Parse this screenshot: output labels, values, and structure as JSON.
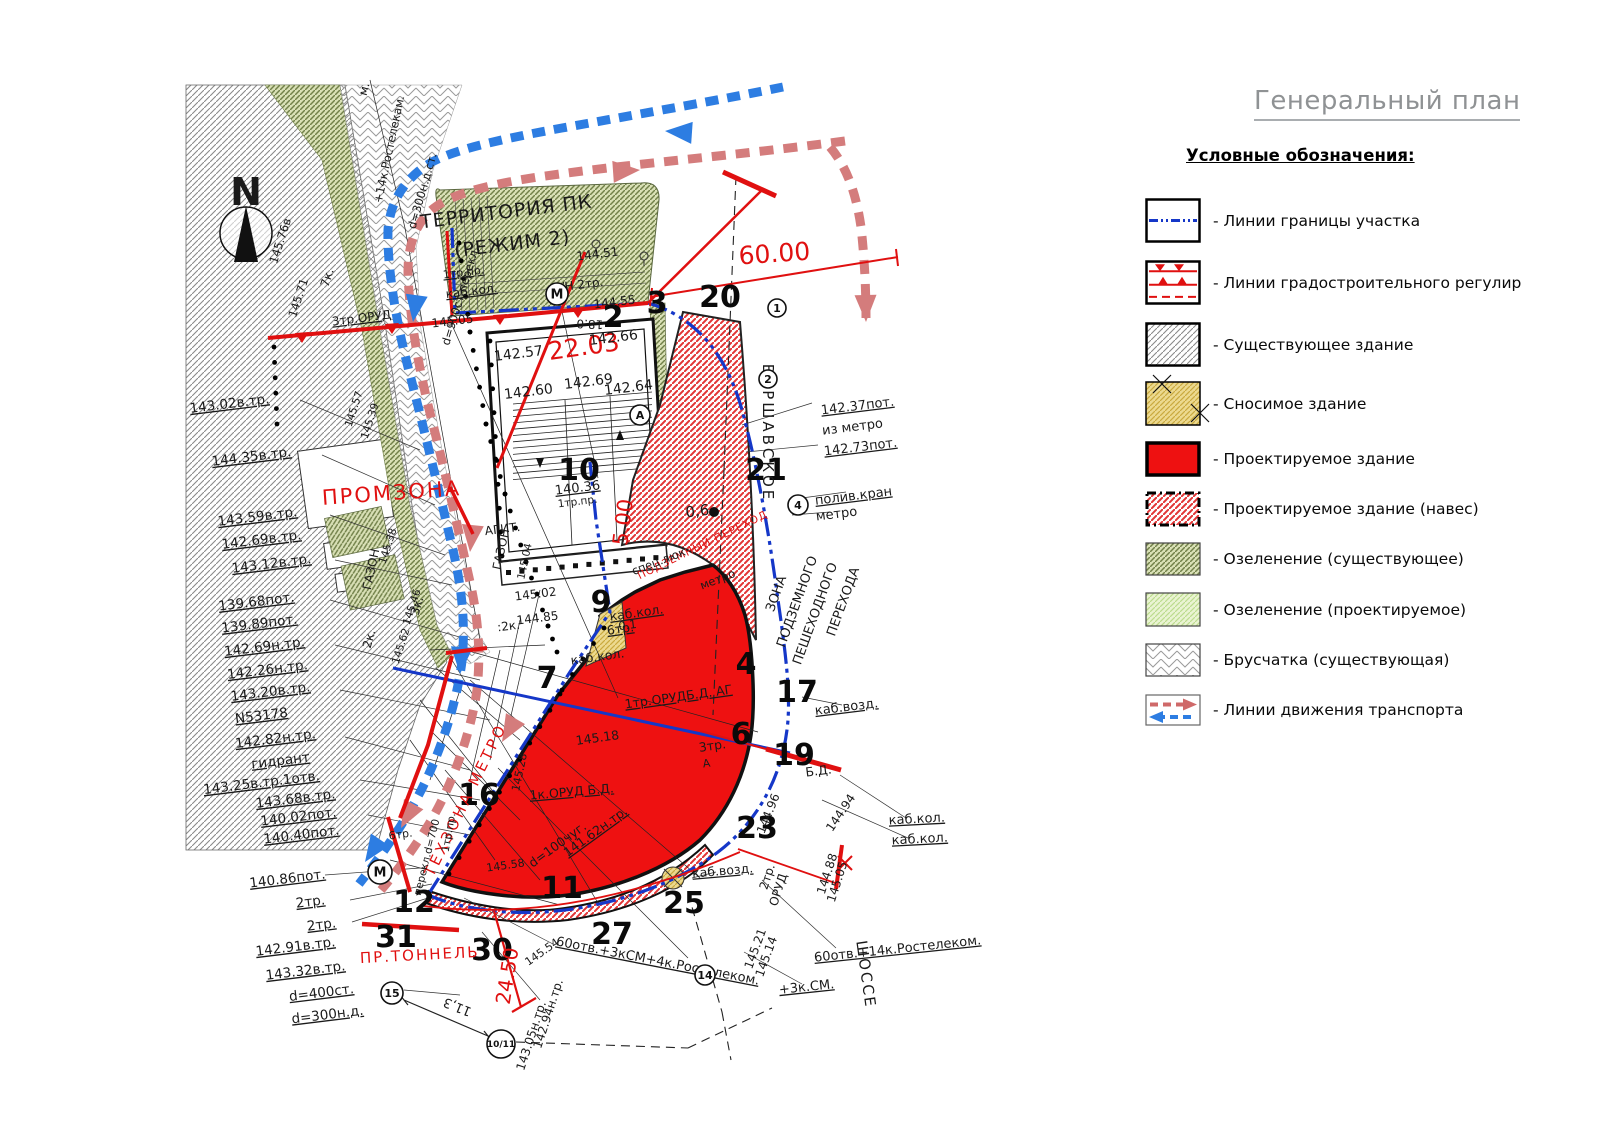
{
  "title": "Генеральный план",
  "legend": {
    "heading": "Условные обозначения:",
    "items": [
      {
        "swatch": "boundary-line",
        "label": "- Линии границы участка"
      },
      {
        "swatch": "regulation-lines",
        "label": "- Линии градостроительного регулир"
      },
      {
        "swatch": "existing-building",
        "label": "- Существующее здание"
      },
      {
        "swatch": "demolished-building",
        "label": "- Сносимое здание"
      },
      {
        "swatch": "projected-building",
        "label": "- Проектируемое здание"
      },
      {
        "swatch": "projected-canopy",
        "label": "- Проектируемое здание (навес)"
      },
      {
        "swatch": "greenery-existing",
        "label": "- Озеленение (существующее)"
      },
      {
        "swatch": "greenery-projected",
        "label": "- Озеленение (проектируемое)"
      },
      {
        "swatch": "paving-existing",
        "label": "- Брусчатка (существующая)"
      },
      {
        "swatch": "transport-lines",
        "label": "- Линии движения транспорта"
      }
    ]
  },
  "colors": {
    "red": "#e01010",
    "building_red": "#ee1111",
    "boundary_blue": "#1537c8",
    "road_blue": "#2d7de2",
    "road_pink": "#d47c7c",
    "green_dark": "#72814a",
    "green_light": "#bcdc8e",
    "yellow": "#ecd98f",
    "gray": "#8a8a8a"
  },
  "compass": {
    "label": "N"
  },
  "map": {
    "numbers": [
      {
        "t": "2",
        "x": 613,
        "y": 327
      },
      {
        "t": "3",
        "x": 657,
        "y": 313
      },
      {
        "t": "20",
        "x": 720,
        "y": 307
      },
      {
        "t": "10",
        "x": 579,
        "y": 480
      },
      {
        "t": "9",
        "x": 601,
        "y": 612
      },
      {
        "t": "21",
        "x": 766,
        "y": 480
      },
      {
        "t": "7",
        "x": 547,
        "y": 688
      },
      {
        "t": "4",
        "x": 746,
        "y": 674
      },
      {
        "t": "17",
        "x": 797,
        "y": 702
      },
      {
        "t": "6",
        "x": 741,
        "y": 744
      },
      {
        "t": "19",
        "x": 794,
        "y": 765
      },
      {
        "t": "23",
        "x": 757,
        "y": 838
      },
      {
        "t": "16",
        "x": 479,
        "y": 805
      },
      {
        "t": "12",
        "x": 414,
        "y": 912
      },
      {
        "t": "31",
        "x": 396,
        "y": 947
      },
      {
        "t": "30",
        "x": 492,
        "y": 960
      },
      {
        "t": "27",
        "x": 612,
        "y": 944
      },
      {
        "t": "11",
        "x": 562,
        "y": 898
      },
      {
        "t": "25",
        "x": 684,
        "y": 913
      }
    ],
    "red_texts": [
      {
        "t": "60.00",
        "x": 775,
        "y": 262,
        "r": -4,
        "s": 25
      },
      {
        "t": "22.03",
        "x": 585,
        "y": 355,
        "r": -8,
        "s": 25
      },
      {
        "t": "ПРОМЗОНА",
        "x": 392,
        "y": 500,
        "r": -4,
        "s": 21,
        "ls": 2
      },
      {
        "t": "5.00",
        "x": 630,
        "y": 523,
        "r": -83,
        "s": 21
      },
      {
        "t": "ТЕХЗОНА МЕТРО",
        "x": 470,
        "y": 802,
        "r": -64,
        "s": 15,
        "ls": 3
      },
      {
        "t": "ПР.ТОННЕЛЬ",
        "x": 420,
        "y": 960,
        "r": -3,
        "s": 15,
        "ls": 2
      },
      {
        "t": "24.50",
        "x": 514,
        "y": 977,
        "r": -81,
        "s": 20
      },
      {
        "t": "ПОДЗЕМНЫЙ ПЕРЕХОД",
        "x": 704,
        "y": 548,
        "r": -26,
        "s": 10.5,
        "ls": 1
      }
    ],
    "texts": [
      {
        "t": "ТЕРРИТОРИЯ ПК",
        "x": 507,
        "y": 218,
        "r": -7,
        "s": 19,
        "ls": 1
      },
      {
        "t": "(РЕЖИМ 2)",
        "x": 513,
        "y": 250,
        "r": -7,
        "s": 19,
        "ls": 1
      },
      {
        "t": "144.51",
        "x": 598,
        "y": 258,
        "r": -7,
        "s": 12
      },
      {
        "t": "1тр.пр.",
        "x": 464,
        "y": 276,
        "r": -7,
        "s": 11,
        "u": 1
      },
      {
        "t": "каб.кол.",
        "x": 472,
        "y": 295,
        "r": -7,
        "s": 12,
        "u": 1
      },
      {
        "t": "Н/Н 2тр.",
        "x": 578,
        "y": 289,
        "r": -7,
        "s": 12
      },
      {
        "t": "145.05",
        "x": 453,
        "y": 325,
        "r": -7,
        "s": 12
      },
      {
        "t": "144.55",
        "x": 615,
        "y": 306,
        "r": -7,
        "s": 12
      },
      {
        "t": "18.0",
        "x": 590,
        "y": 320,
        "r": 182,
        "s": 12
      },
      {
        "t": "142.57",
        "x": 519,
        "y": 358,
        "r": -7,
        "s": 14
      },
      {
        "t": "142.66",
        "x": 614,
        "y": 342,
        "r": -7,
        "s": 14
      },
      {
        "t": "142.60",
        "x": 529,
        "y": 396,
        "r": -7,
        "s": 14
      },
      {
        "t": "142.69",
        "x": 589,
        "y": 386,
        "r": -7,
        "s": 14
      },
      {
        "t": "142.64",
        "x": 629,
        "y": 392,
        "r": -7,
        "s": 14
      },
      {
        "t": "140.36",
        "x": 578,
        "y": 492,
        "r": -7,
        "s": 13,
        "u": 1
      },
      {
        "t": "1тр.пр.",
        "x": 578,
        "y": 505,
        "r": -7,
        "s": 10.5
      },
      {
        "t": "АГИТ.",
        "x": 503,
        "y": 533,
        "r": -7,
        "s": 12
      },
      {
        "t": "ГАЗОН",
        "x": 505,
        "y": 550,
        "r": -78,
        "s": 12
      },
      {
        "t": "145.04",
        "x": 528,
        "y": 562,
        "r": -78,
        "s": 10.5
      },
      {
        "t": "145.02",
        "x": 536,
        "y": 598,
        "r": -7,
        "s": 12
      },
      {
        "t": "144.85",
        "x": 538,
        "y": 622,
        "r": -7,
        "s": 12
      },
      {
        "t": ":2к.",
        "x": 509,
        "y": 630,
        "r": -7,
        "s": 12
      },
      {
        "t": "ГАЗОН",
        "x": 375,
        "y": 570,
        "r": -78,
        "s": 12
      },
      {
        "t": "2к.",
        "x": 373,
        "y": 640,
        "r": -74,
        "s": 12
      },
      {
        "t": "3к.",
        "x": 421,
        "y": 607,
        "r": -74,
        "s": 12
      },
      {
        "t": "м.",
        "x": 368,
        "y": 90,
        "r": -75,
        "s": 12
      },
      {
        "t": "+14к.Ростелекам.",
        "x": 393,
        "y": 150,
        "r": -78,
        "s": 11.5
      },
      {
        "t": "d=300н.д.ст.",
        "x": 426,
        "y": 192,
        "r": -74,
        "s": 11.5
      },
      {
        "t": "d=900ст.перекл.",
        "x": 464,
        "y": 297,
        "r": -73,
        "s": 11.5
      },
      {
        "t": "7к.",
        "x": 331,
        "y": 279,
        "r": -72,
        "s": 12
      },
      {
        "t": "3тр.ОРУД",
        "x": 362,
        "y": 322,
        "r": -7,
        "s": 12,
        "u": 1
      },
      {
        "t": "145.76в",
        "x": 284,
        "y": 242,
        "r": -72,
        "s": 11.5
      },
      {
        "t": "145.71",
        "x": 302,
        "y": 299,
        "r": -72,
        "s": 11.5
      },
      {
        "t": "145.57",
        "x": 357,
        "y": 410,
        "r": -72,
        "s": 10.5
      },
      {
        "t": "145.39",
        "x": 373,
        "y": 422,
        "r": -72,
        "s": 10.5
      },
      {
        "t": "145.38",
        "x": 391,
        "y": 547,
        "r": -72,
        "s": 10.5
      },
      {
        "t": "145.46",
        "x": 415,
        "y": 608,
        "r": -72,
        "s": 10.5
      },
      {
        "t": "145.62",
        "x": 404,
        "y": 647,
        "r": -72,
        "s": 10.5
      },
      {
        "t": "0,6",
        "x": 698,
        "y": 516,
        "r": -7,
        "s": 15
      },
      {
        "t": "0.1",
        "x": 628,
        "y": 629,
        "r": -7,
        "s": 11.5
      },
      {
        "t": "спец.люк",
        "x": 660,
        "y": 565,
        "r": -21,
        "s": 11.5
      },
      {
        "t": "метро",
        "x": 719,
        "y": 583,
        "r": -21,
        "s": 11.5
      },
      {
        "t": "каб.кол.",
        "x": 637,
        "y": 617,
        "r": -8,
        "s": 12.5,
        "u": 1
      },
      {
        "t": "6тр.",
        "x": 621,
        "y": 633,
        "r": -8,
        "s": 12.5,
        "u": 1
      },
      {
        "t": "каб.кол.",
        "x": 598,
        "y": 661,
        "r": -8,
        "s": 12.5
      },
      {
        "t": "1тр.ОРУДБ.Д.  АГ",
        "x": 679,
        "y": 701,
        "r": -8,
        "s": 12.5,
        "u": 1
      },
      {
        "t": "3тр.",
        "x": 713,
        "y": 750,
        "r": -8,
        "s": 12.5
      },
      {
        "t": "А",
        "x": 707,
        "y": 767,
        "r": -8,
        "s": 11
      },
      {
        "t": "145.18",
        "x": 598,
        "y": 742,
        "r": -8,
        "s": 12.5
      },
      {
        "t": "1к.ОРУД  Б.Д.",
        "x": 572,
        "y": 796,
        "r": -5,
        "s": 12.5,
        "u": 1
      },
      {
        "t": "141.62н.тр.",
        "x": 598,
        "y": 835,
        "r": -36,
        "s": 12.5,
        "u": 1
      },
      {
        "t": "d=100чуг.",
        "x": 560,
        "y": 848,
        "r": -36,
        "s": 12.5
      },
      {
        "t": "145.28",
        "x": 523,
        "y": 773,
        "r": -78,
        "s": 11
      },
      {
        "t": "145.58",
        "x": 506,
        "y": 869,
        "r": -8,
        "s": 11
      },
      {
        "t": "1тр.пр.",
        "x": 452,
        "y": 833,
        "r": -80,
        "s": 10.5
      },
      {
        "t": "перекл.d=700",
        "x": 430,
        "y": 858,
        "r": -76,
        "s": 10.5
      },
      {
        "t": "6тр.",
        "x": 401,
        "y": 838,
        "r": -8,
        "s": 11
      },
      {
        "t": "142.37пот.",
        "x": 858,
        "y": 410,
        "r": -7,
        "s": 13,
        "u": 1
      },
      {
        "t": "из метро",
        "x": 853,
        "y": 431,
        "r": -7,
        "s": 13
      },
      {
        "t": "142.73пот.",
        "x": 861,
        "y": 451,
        "r": -7,
        "s": 13,
        "u": 1
      },
      {
        "t": "полив.кран",
        "x": 854,
        "y": 500,
        "r": -7,
        "s": 13,
        "u": 1
      },
      {
        "t": "метро",
        "x": 837,
        "y": 518,
        "r": -7,
        "s": 13
      },
      {
        "t": "ЗОНА",
        "x": 780,
        "y": 595,
        "r": -70,
        "s": 13
      },
      {
        "t": "ПОДЗЕМНОГО",
        "x": 801,
        "y": 603,
        "r": -70,
        "s": 13
      },
      {
        "t": "ПЕШЕХОДНОГО",
        "x": 819,
        "y": 615,
        "r": -70,
        "s": 13
      },
      {
        "t": "ПЕРЕХОДА",
        "x": 847,
        "y": 603,
        "r": -70,
        "s": 13
      },
      {
        "t": "ВАРШАВСКОЕ",
        "x": 763,
        "y": 433,
        "r": 90,
        "s": 15,
        "ls": 3
      },
      {
        "t": "ШОССЕ",
        "x": 861,
        "y": 975,
        "r": 82,
        "s": 15,
        "ls": 2
      },
      {
        "t": "каб.возд.",
        "x": 847,
        "y": 711,
        "r": -7,
        "s": 13,
        "u": 1
      },
      {
        "t": "каб.возд.",
        "x": 723,
        "y": 875,
        "r": -5,
        "s": 12.5,
        "u": 1
      },
      {
        "t": "каб.кол.",
        "x": 917,
        "y": 823,
        "r": -3,
        "s": 13,
        "u": 1
      },
      {
        "t": "каб.кол.",
        "x": 920,
        "y": 843,
        "r": -3,
        "s": 13,
        "u": 1
      },
      {
        "t": "Б.Д.",
        "x": 819,
        "y": 775,
        "r": -7,
        "s": 12.5
      },
      {
        "t": "2тр.",
        "x": 771,
        "y": 878,
        "r": -72,
        "s": 12
      },
      {
        "t": "ОРУД",
        "x": 782,
        "y": 891,
        "r": -72,
        "s": 12
      },
      {
        "t": "144.96",
        "x": 772,
        "y": 815,
        "r": -68,
        "s": 12
      },
      {
        "t": "144.94",
        "x": 844,
        "y": 815,
        "r": -56,
        "s": 12
      },
      {
        "t": "144.88",
        "x": 831,
        "y": 875,
        "r": -72,
        "s": 12
      },
      {
        "t": "145.05",
        "x": 841,
        "y": 883,
        "r": -72,
        "s": 12
      },
      {
        "t": "145.21",
        "x": 759,
        "y": 950,
        "r": -70,
        "s": 12
      },
      {
        "t": "145.14",
        "x": 770,
        "y": 958,
        "r": -70,
        "s": 12
      },
      {
        "t": "60отв.+3кСМ+4к.Ростелеком.",
        "x": 657,
        "y": 965,
        "r": 11,
        "s": 13,
        "u": 1
      },
      {
        "t": "60отв.+14к.Ростелеком.",
        "x": 898,
        "y": 953,
        "r": -6,
        "s": 13,
        "u": 1
      },
      {
        "t": "+3к.СМ.",
        "x": 807,
        "y": 991,
        "r": -6,
        "s": 13,
        "u": 1
      },
      {
        "t": "142.94н.тр.",
        "x": 552,
        "y": 1015,
        "r": -72,
        "s": 12
      },
      {
        "t": "143.05н.тр.",
        "x": 535,
        "y": 1037,
        "r": -72,
        "s": 12
      },
      {
        "t": "145.54",
        "x": 544,
        "y": 955,
        "r": -35,
        "s": 11
      },
      {
        "t": "11,3",
        "x": 459,
        "y": 1003,
        "r": -158,
        "s": 13
      },
      {
        "t": "N",
        "x": 246,
        "y": 205,
        "s": 38,
        "b": 1
      }
    ],
    "left_labels": [
      {
        "t": "143.02в.тр.",
        "x": 230,
        "y": 408
      },
      {
        "t": "144.35в.тр.",
        "x": 252,
        "y": 461
      },
      {
        "t": "143.59в.тр.",
        "x": 258,
        "y": 521
      },
      {
        "t": "142.69в.тр.",
        "x": 262,
        "y": 544
      },
      {
        "t": "143.12в.тр.",
        "x": 272,
        "y": 568
      },
      {
        "t": "139.68пот.",
        "x": 257,
        "y": 606
      },
      {
        "t": "139.89пот.",
        "x": 260,
        "y": 628
      },
      {
        "t": "142.69н.тр.",
        "x": 265,
        "y": 651
      },
      {
        "t": "142.26н.тр.",
        "x": 268,
        "y": 674
      },
      {
        "t": "143.20в.тр.",
        "x": 271,
        "y": 696
      },
      {
        "t": "N53178",
        "x": 262,
        "y": 720
      },
      {
        "t": "142.82н.тр.",
        "x": 276,
        "y": 743
      },
      {
        "t": "гидрант",
        "x": 281,
        "y": 765
      },
      {
        "t": "143.25в.тр.1отв.",
        "x": 262,
        "y": 787
      },
      {
        "t": "143.68в.тр.",
        "x": 296,
        "y": 803
      },
      {
        "t": "140.02пот.",
        "x": 299,
        "y": 821
      },
      {
        "t": "140.40пот.",
        "x": 302,
        "y": 839
      },
      {
        "t": "140.86пот.",
        "x": 288,
        "y": 883
      },
      {
        "t": "2тр.",
        "x": 311,
        "y": 906
      },
      {
        "t": "2тр.",
        "x": 322,
        "y": 929
      },
      {
        "t": "142.91в.тр.",
        "x": 296,
        "y": 951
      },
      {
        "t": "143.32в.тр.",
        "x": 306,
        "y": 975
      },
      {
        "t": "d=400ст.",
        "x": 322,
        "y": 997
      },
      {
        "t": "d=300н.д.",
        "x": 328,
        "y": 1019
      }
    ],
    "circled": [
      {
        "t": "М",
        "x": 557,
        "y": 294,
        "rad": 11,
        "s": 13
      },
      {
        "t": "М",
        "x": 380,
        "y": 872,
        "rad": 12,
        "s": 13
      },
      {
        "t": "1",
        "x": 777,
        "y": 308,
        "rad": 9,
        "s": 11
      },
      {
        "t": "2",
        "x": 768,
        "y": 379,
        "rad": 9,
        "s": 11
      },
      {
        "t": "А",
        "x": 640,
        "y": 415,
        "rad": 10,
        "s": 11
      },
      {
        "t": "4",
        "x": 798,
        "y": 505,
        "rad": 10,
        "s": 11
      },
      {
        "t": "15",
        "x": 392,
        "y": 993,
        "rad": 11,
        "s": 11
      },
      {
        "t": "10/11",
        "x": 501,
        "y": 1044,
        "rad": 14,
        "s": 9
      },
      {
        "t": "14",
        "x": 705,
        "y": 975,
        "rad": 10,
        "s": 11
      }
    ]
  }
}
